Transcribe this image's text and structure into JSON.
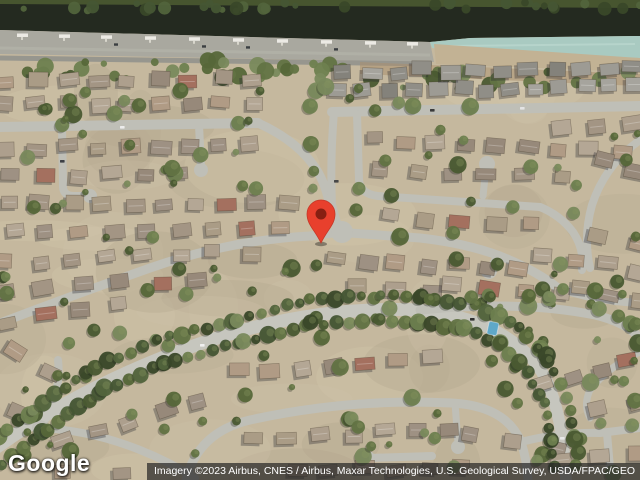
{
  "map": {
    "logo_text": "Google",
    "attribution_text": "Imagery ©2023 Airbus, CNES / Airbus, Maxar Technologies, U.S. Geological Survey, USDA/FPAC/GEO",
    "marker": {
      "fill": "#E8402D",
      "rim": "#C53727",
      "dot": "#861F12",
      "x": 321,
      "y": 243
    },
    "colors": {
      "ground": "#c5b89e",
      "ground_patches": [
        "#cec1a7",
        "#b9ac92",
        "#d3c6ac",
        "#b1a58c"
      ],
      "street": "#bfbfb7",
      "arterial": "#c6c6be",
      "water_dark": "#242a20",
      "water_shallow": "#a9cac1",
      "water_streak": "#c3ded6",
      "bank_left": "#a9a89f",
      "bank_right": "#c2b294",
      "canal_road": "#97968e",
      "dock": "#eceae4",
      "dirt": "#a98f6f",
      "pool": "#5fa8c8",
      "house_palette": [
        "#a39584",
        "#ad9f8d",
        "#97897a",
        "#b4a795",
        "#9e9183",
        "#aa9c86",
        "#b09b85"
      ],
      "house_gray_palette": [
        "#908e87",
        "#9d9b94",
        "#84827b",
        "#a6a49d"
      ],
      "house_red": "#a4705f",
      "tree_palette": [
        "#4a5a31",
        "#566739",
        "#627343",
        "#6e7f4f",
        "#79895c"
      ],
      "tree_dark": [
        "#3a4829",
        "#465634",
        "#52643c"
      ],
      "attribution_bg": "rgba(35,35,35,0.7)"
    }
  }
}
